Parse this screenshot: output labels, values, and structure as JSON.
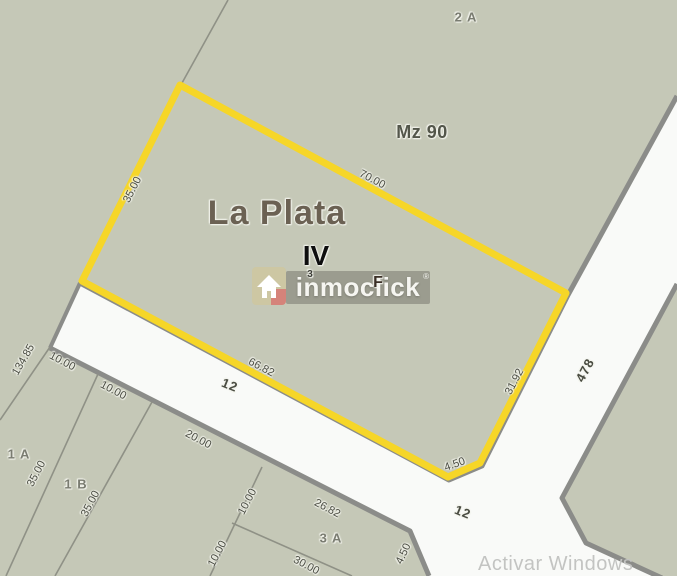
{
  "map": {
    "city_label": "La Plata",
    "section_label": "IV",
    "block_label": "Mz 90",
    "highlighted_parcel": "F",
    "streets": [
      "12",
      "478"
    ],
    "parcels": [
      "2 A",
      "1 A",
      "1 B",
      "3 A",
      "F",
      "3"
    ],
    "dimensions": [
      "70.00",
      "35.00",
      "66.82",
      "31.92",
      "4.50",
      "134.85",
      "10.00",
      "10.00",
      "20.00",
      "26.82",
      "30.00",
      "10.00",
      "10.00",
      "35.00",
      "35.00",
      "4.50"
    ]
  },
  "map_labels": [
    {
      "name": "parcel-label-2a",
      "text": "2 A",
      "x": 466,
      "y": 17,
      "rot": 0,
      "cls": "parcel"
    },
    {
      "name": "block-label-mz90",
      "text": "Mz 90",
      "x": 422,
      "y": 132,
      "rot": 0,
      "cls": "block"
    },
    {
      "name": "city-label",
      "text": "La Plata",
      "x": 277,
      "y": 213,
      "rot": 0,
      "cls": "city"
    },
    {
      "name": "section-label",
      "text": "IV",
      "x": 316,
      "y": 256,
      "rot": 0,
      "cls": "section"
    },
    {
      "name": "dim-top-edge",
      "text": "70.00",
      "x": 372,
      "y": 180,
      "rot": 28,
      "cls": "dim"
    },
    {
      "name": "dim-left-edge",
      "text": "35.00",
      "x": 133,
      "y": 190,
      "rot": -63,
      "cls": "dim"
    },
    {
      "name": "dim-bottom-edge",
      "text": "66.82",
      "x": 261,
      "y": 368,
      "rot": 28,
      "cls": "dim"
    },
    {
      "name": "dim-right-edge",
      "text": "31.92",
      "x": 515,
      "y": 382,
      "rot": -62,
      "cls": "dim"
    },
    {
      "name": "dim-corner-cut",
      "text": "4.50",
      "x": 455,
      "y": 465,
      "rot": -20,
      "cls": "dim"
    },
    {
      "name": "parcel-label-f",
      "text": "F",
      "x": 378,
      "y": 283,
      "rot": 0,
      "cls": "parcel-f"
    },
    {
      "name": "parcel-label-3",
      "text": "3",
      "x": 310,
      "y": 275,
      "rot": 0,
      "cls": "tiny"
    },
    {
      "name": "dim-134-85",
      "text": "134.85",
      "x": 24,
      "y": 360,
      "rot": -60,
      "cls": "dim"
    },
    {
      "name": "dim-frontage-1a",
      "text": "10.00",
      "x": 62,
      "y": 362,
      "rot": 28,
      "cls": "dim"
    },
    {
      "name": "dim-frontage-1b",
      "text": "10.00",
      "x": 113,
      "y": 391,
      "rot": 28,
      "cls": "dim"
    },
    {
      "name": "dim-frontage-20",
      "text": "20.00",
      "x": 198,
      "y": 440,
      "rot": 28,
      "cls": "dim"
    },
    {
      "name": "dim-frontage-3a",
      "text": "26.82",
      "x": 327,
      "y": 509,
      "rot": 28,
      "cls": "dim"
    },
    {
      "name": "dim-backline-3a",
      "text": "30.00",
      "x": 306,
      "y": 566,
      "rot": 28,
      "cls": "dim"
    },
    {
      "name": "parcel-label-1a",
      "text": "1 A",
      "x": 19,
      "y": 454,
      "rot": 0,
      "cls": "parcel"
    },
    {
      "name": "dim-depth-1a",
      "text": "35.00",
      "x": 37,
      "y": 474,
      "rot": -62,
      "cls": "dim"
    },
    {
      "name": "parcel-label-1b",
      "text": "1 B",
      "x": 76,
      "y": 484,
      "rot": 0,
      "cls": "parcel"
    },
    {
      "name": "dim-depth-1b",
      "text": "91",
      "x": 91,
      "y": 504,
      "rot": -62,
      "cls": "dim"
    },
    {
      "name": "parcel-label-3a",
      "text": "3 A",
      "x": 331,
      "y": 538,
      "rot": 0,
      "cls": "parcel"
    },
    {
      "name": "dim-depth-3a-1",
      "text": "10.00",
      "x": 248,
      "y": 502,
      "rot": -62,
      "cls": "dim"
    },
    {
      "name": "dim-depth-3a-2",
      "text": "10.00",
      "x": 218,
      "y": 554,
      "rot": -62,
      "cls": "dim"
    },
    {
      "name": "street-label-12-west",
      "text": "12",
      "x": 230,
      "y": 385,
      "rot": 22,
      "cls": "street"
    },
    {
      "name": "street-label-12-east",
      "text": "12",
      "x": 463,
      "y": 512,
      "rot": 22,
      "cls": "street"
    },
    {
      "name": "street-label-478",
      "text": "478",
      "x": 585,
      "y": 370,
      "rot": -62,
      "cls": "street"
    },
    {
      "name": "dim-corner-cut-south",
      "text": "4.50",
      "x": 404,
      "y": 554,
      "rot": -65,
      "cls": "dim"
    }
  ],
  "watermark": {
    "brand": "inmoclick",
    "registered": "®"
  },
  "windows_notice": "Activar Windows",
  "colors": {
    "highlight_yellow": "#f6d628",
    "parcel_fill": "#c5c8b7",
    "street_fill": "#f9faf8",
    "street_border": "#8b8c89",
    "thin_line": "#8f9186"
  }
}
